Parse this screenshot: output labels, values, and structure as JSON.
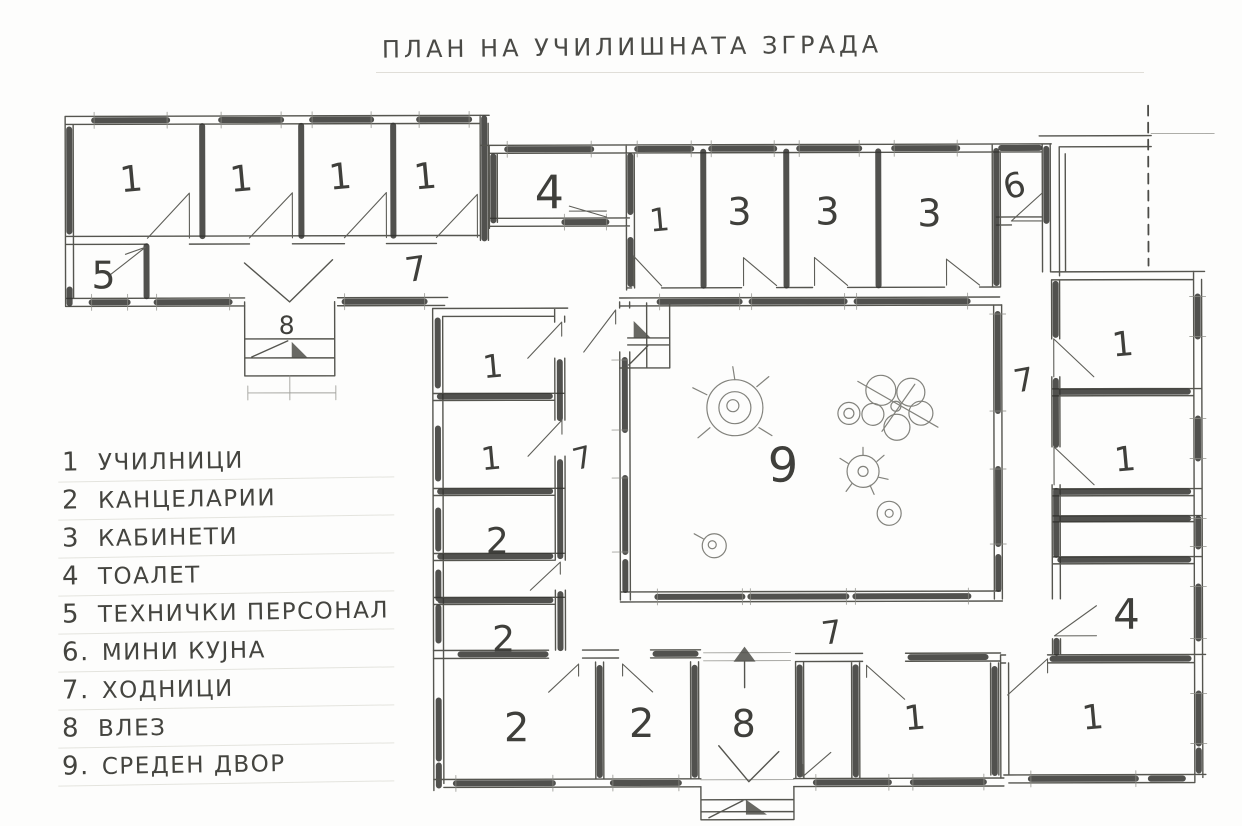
{
  "title": "ПЛАН НА УЧИЛИШНАТА ЗГРАДА",
  "legend": {
    "items": [
      {
        "num": "1",
        "label": "УЧИЛНИЦИ"
      },
      {
        "num": "2",
        "label": "КАНЦЕЛАРИИ"
      },
      {
        "num": "3",
        "label": "КАБИНЕТИ"
      },
      {
        "num": "4",
        "label": "ТОАЛЕТ"
      },
      {
        "num": "5",
        "label": "ТЕХНИЧКИ ПЕРСОНАЛ"
      },
      {
        "num": "6.",
        "label": "МИНИ КУЈНА"
      },
      {
        "num": "7.",
        "label": "ХОДНИЦИ"
      },
      {
        "num": "8",
        "label": "ВЛЕЗ"
      },
      {
        "num": "9.",
        "label": "СРЕДЕН ДВОР"
      }
    ]
  },
  "plan": {
    "pencil_color": "#55554f",
    "dark_wall_color": "#33332f",
    "paper_color": "#fdfdfc",
    "room_labels": [
      {
        "t": "1",
        "x": 133,
        "y": 190,
        "s": 36,
        "r": -5
      },
      {
        "t": "1",
        "x": 243,
        "y": 190,
        "s": 36,
        "r": -5
      },
      {
        "t": "1",
        "x": 342,
        "y": 188,
        "s": 36,
        "r": -5
      },
      {
        "t": "1",
        "x": 427,
        "y": 188,
        "s": 36,
        "r": -5
      },
      {
        "t": "5",
        "x": 104,
        "y": 287,
        "s": 38,
        "r": 0
      },
      {
        "t": "7",
        "x": 418,
        "y": 280,
        "s": 34,
        "r": -8
      },
      {
        "t": "8",
        "x": 287,
        "y": 333,
        "s": 25,
        "r": 0
      },
      {
        "t": "4",
        "x": 550,
        "y": 208,
        "s": 46,
        "r": 0
      },
      {
        "t": "1",
        "x": 661,
        "y": 231,
        "s": 32,
        "r": -5
      },
      {
        "t": "3",
        "x": 740,
        "y": 225,
        "s": 38,
        "r": 0
      },
      {
        "t": "3",
        "x": 828,
        "y": 225,
        "s": 38,
        "r": 0
      },
      {
        "t": "3",
        "x": 930,
        "y": 227,
        "s": 38,
        "r": 0
      },
      {
        "t": "6",
        "x": 1018,
        "y": 198,
        "s": 34,
        "r": -15
      },
      {
        "t": "7",
        "x": 1026,
        "y": 392,
        "s": 32,
        "r": -10
      },
      {
        "t": "1",
        "x": 1124,
        "y": 357,
        "s": 34,
        "r": -5
      },
      {
        "t": "1",
        "x": 1126,
        "y": 472,
        "s": 34,
        "r": -5
      },
      {
        "t": "4",
        "x": 1126,
        "y": 630,
        "s": 42,
        "r": 0
      },
      {
        "t": "1",
        "x": 1093,
        "y": 730,
        "s": 34,
        "r": -5
      },
      {
        "t": "9",
        "x": 783,
        "y": 482,
        "s": 48,
        "r": 0
      },
      {
        "t": "7",
        "x": 585,
        "y": 468,
        "s": 30,
        "r": -14
      },
      {
        "t": "1",
        "x": 494,
        "y": 377,
        "s": 32,
        "r": -5
      },
      {
        "t": "1",
        "x": 492,
        "y": 469,
        "s": 32,
        "r": -5
      },
      {
        "t": "2",
        "x": 497,
        "y": 553,
        "s": 36,
        "r": 0
      },
      {
        "t": "2",
        "x": 503,
        "y": 651,
        "s": 36,
        "r": 0
      },
      {
        "t": "2",
        "x": 516,
        "y": 741,
        "s": 40,
        "r": 0
      },
      {
        "t": "2",
        "x": 641,
        "y": 737,
        "s": 40,
        "r": 0
      },
      {
        "t": "8",
        "x": 743,
        "y": 737,
        "s": 38,
        "r": 0
      },
      {
        "t": "1",
        "x": 915,
        "y": 730,
        "s": 34,
        "r": -5
      },
      {
        "t": "7",
        "x": 833,
        "y": 644,
        "s": 32,
        "r": -8
      }
    ]
  }
}
